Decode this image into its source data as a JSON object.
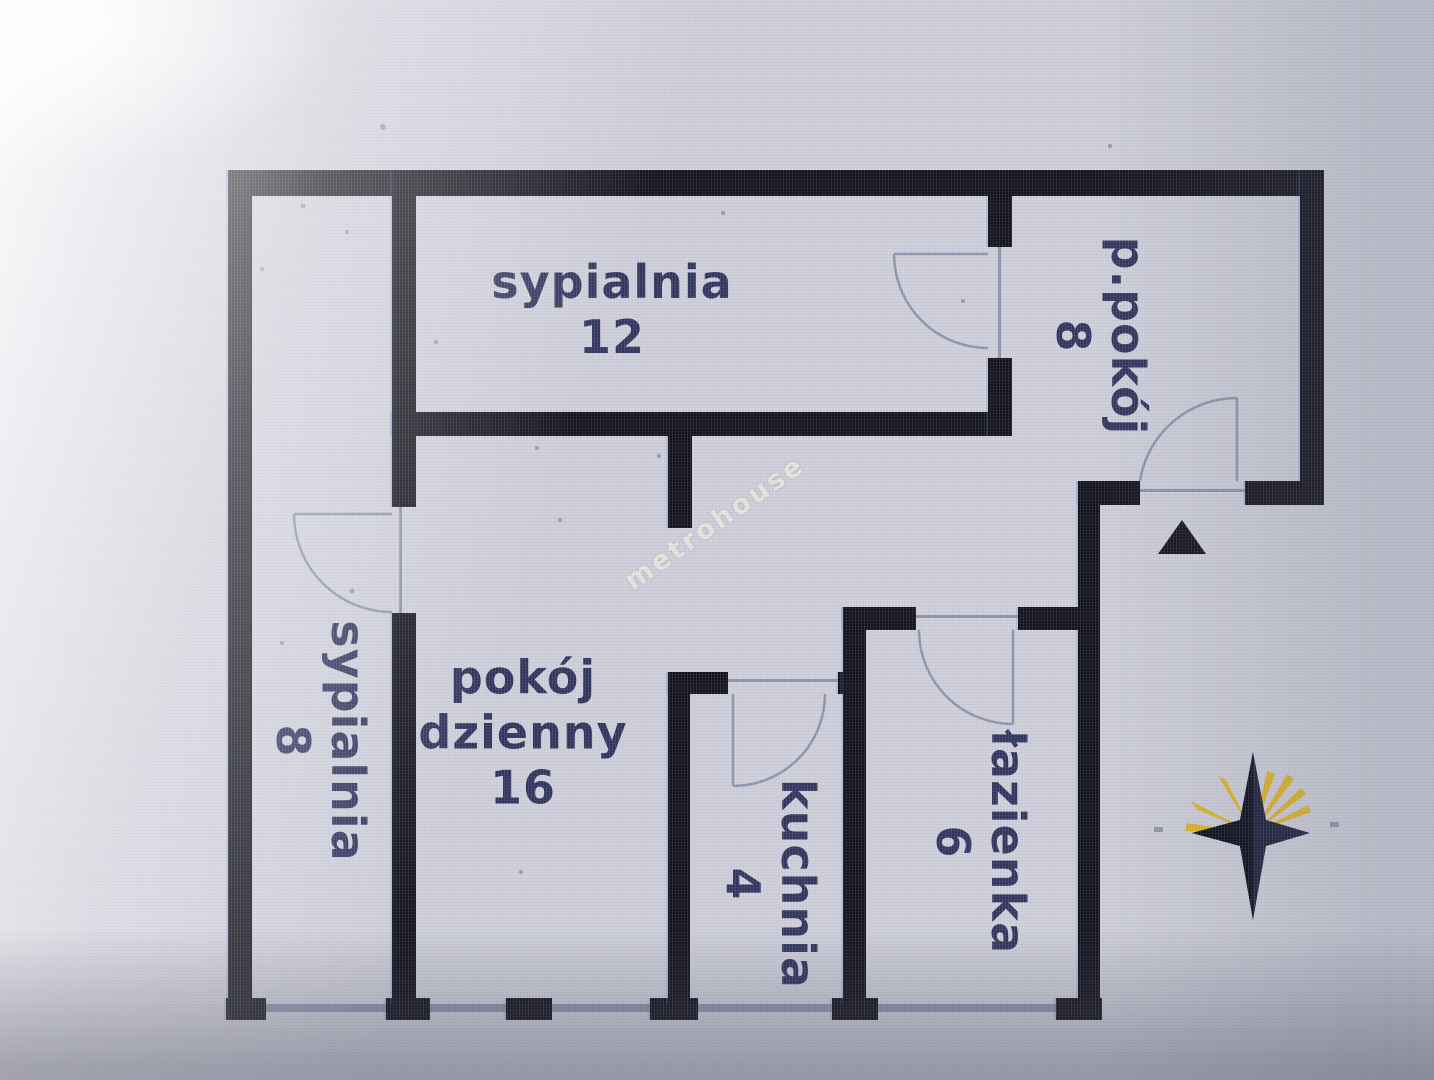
{
  "watermark": {
    "text": "metrohouse"
  },
  "rooms": {
    "sypialnia_12": {
      "name": "sypialnia",
      "area": "12"
    },
    "p_pokoj": {
      "name": "p.pokój",
      "area": "8"
    },
    "sypialnia_8": {
      "name": "sypialnia",
      "area": "8"
    },
    "pokoj_dzienny": {
      "name_line1": "pokój",
      "name_line2": "dzienny",
      "area": "16"
    },
    "kuchnia": {
      "name": "kuchnia",
      "area": "4"
    },
    "lazienka": {
      "name": "łazienka",
      "area": "6"
    }
  },
  "icons": {
    "compass": "compass-rose-icon",
    "entrance_marker": "entrance-triangle-icon"
  },
  "colors": {
    "wall": "#13131d",
    "label_text": "#31345c",
    "door_line": "#8e93ab",
    "compass_star": "#1a2038",
    "compass_rays": "#e0b31d",
    "background": "#cdced9"
  }
}
